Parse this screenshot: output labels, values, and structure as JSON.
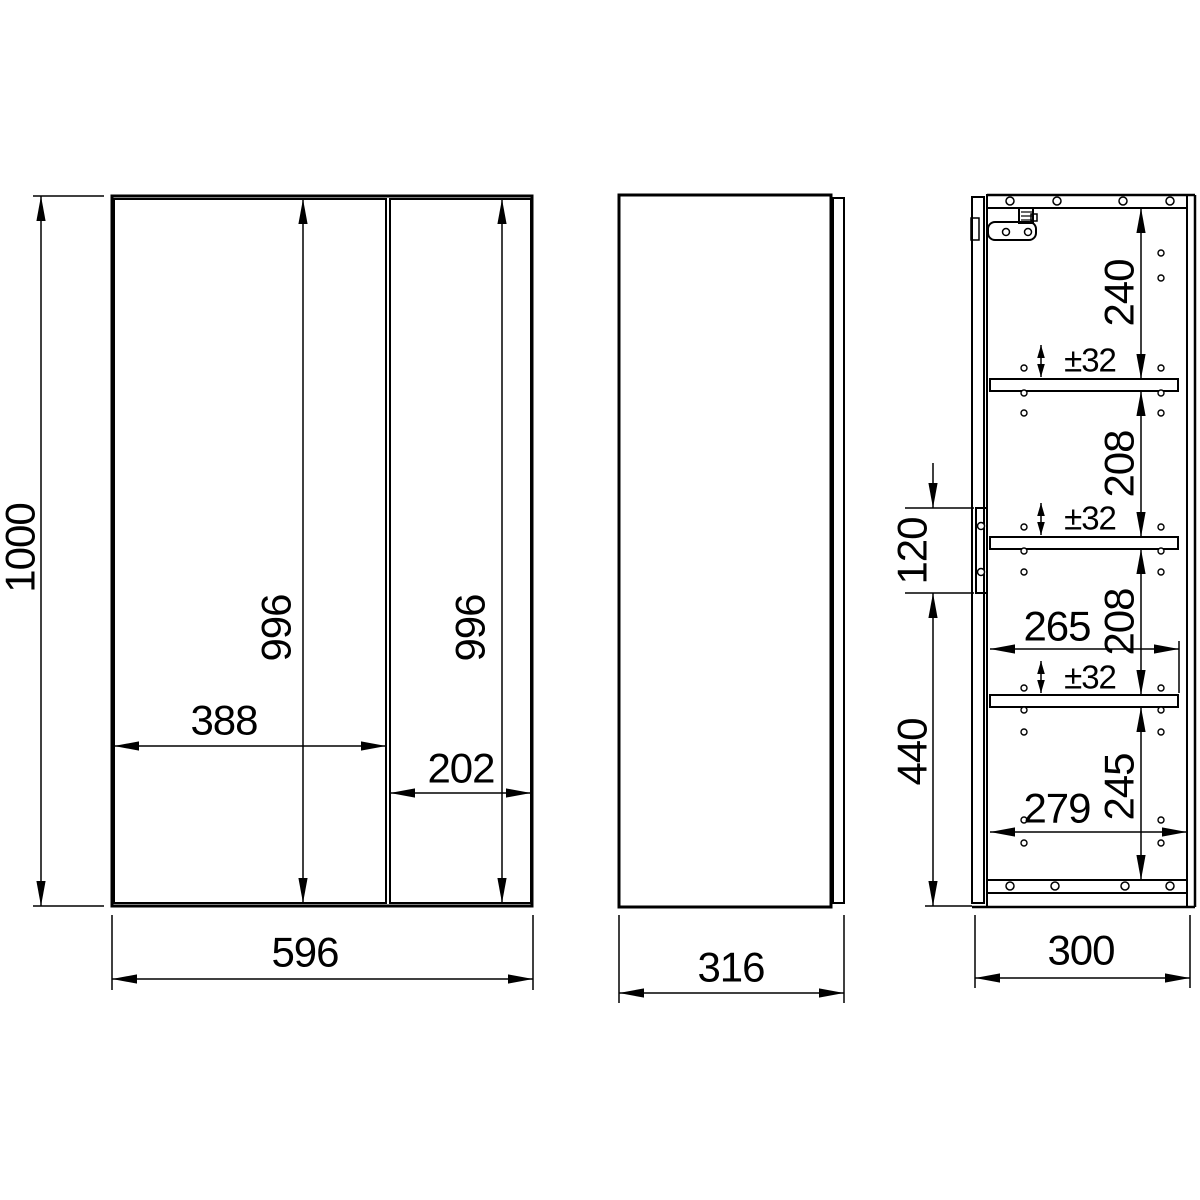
{
  "canvas": {
    "width": 1200,
    "height": 1200,
    "background": "#ffffff",
    "line_color": "#000000"
  },
  "styles": {
    "thick": 3,
    "med": 2,
    "thin": 1.5,
    "font_main": 42,
    "font_small": 33
  },
  "views": {
    "front-view": {
      "rects": [
        {
          "name": "cabinet-outline",
          "x": 112,
          "y": 196,
          "w": 420,
          "h": 710,
          "sw": 3
        },
        {
          "name": "left-door-panel",
          "x": 114,
          "y": 199,
          "w": 272,
          "h": 704,
          "sw": 2
        },
        {
          "name": "right-door-panel",
          "x": 390,
          "y": 199,
          "w": 141,
          "h": 704,
          "sw": 2
        }
      ],
      "lines": [],
      "circles": []
    },
    "side-view": {
      "rects": [
        {
          "name": "side-body-outline",
          "x": 619,
          "y": 195,
          "w": 212,
          "h": 712,
          "sw": 3
        },
        {
          "name": "side-door-edge",
          "x": 833,
          "y": 198,
          "w": 11,
          "h": 705,
          "sw": 2
        }
      ],
      "lines": [],
      "circles": []
    },
    "section-view": {
      "rects": [
        {
          "name": "section-door-panel",
          "x": 972,
          "y": 197,
          "w": 12,
          "h": 706,
          "sw": 2
        },
        {
          "name": "top-panel",
          "x": 987,
          "y": 195,
          "w": 200,
          "h": 13,
          "sw": 2
        },
        {
          "name": "bottom-panel",
          "x": 987,
          "y": 880,
          "w": 200,
          "h": 13,
          "sw": 2
        },
        {
          "name": "shelf-1",
          "x": 990,
          "y": 379,
          "w": 188,
          "h": 12,
          "sw": 2
        },
        {
          "name": "shelf-2",
          "x": 990,
          "y": 537,
          "w": 188,
          "h": 12,
          "sw": 2
        },
        {
          "name": "shelf-3",
          "x": 990,
          "y": 695,
          "w": 188,
          "h": 12,
          "sw": 2
        },
        {
          "name": "top-hinge-mechanism",
          "x": 1019,
          "y": 208,
          "w": 14,
          "h": 15,
          "sw": 2
        },
        {
          "name": "top-hinge-step",
          "x": 1031,
          "y": 214,
          "w": 6,
          "h": 7,
          "sw": 1.5
        },
        {
          "name": "top-hinge-plate",
          "x": 988,
          "y": 222,
          "w": 48,
          "h": 18,
          "sw": 2,
          "rx": 7
        },
        {
          "name": "door-hinge-cup",
          "x": 971,
          "y": 218,
          "w": 8,
          "h": 22,
          "sw": 1.5
        },
        {
          "name": "middle-hinge-plate",
          "x": 976,
          "y": 508,
          "w": 11,
          "h": 85,
          "sw": 2
        }
      ],
      "lines": [
        {
          "name": "carcass-front-edge",
          "p": [
            987,
            195,
            987,
            907
          ],
          "sw": 2
        },
        {
          "name": "back-panel-inner",
          "p": [
            1187,
            195,
            1187,
            907
          ],
          "sw": 2
        },
        {
          "name": "back-panel-outer",
          "p": [
            1195,
            195,
            1195,
            907
          ],
          "sw": 2.5
        },
        {
          "name": "top-edge",
          "p": [
            987,
            195,
            1195,
            195
          ],
          "sw": 2.5
        },
        {
          "name": "bottom-edge",
          "p": [
            972,
            907,
            1195,
            907
          ],
          "sw": 2.5
        },
        {
          "name": "top-hinge-arm",
          "p": [
            987,
            208,
            1020,
            208
          ],
          "sw": 2
        },
        {
          "name": "hinge-hatch-1",
          "p": [
            1021,
            212,
            1032,
            212
          ],
          "sw": 1.2
        },
        {
          "name": "hinge-hatch-2",
          "p": [
            1021,
            216,
            1032,
            216
          ],
          "sw": 1.2
        },
        {
          "name": "hinge-hatch-3",
          "p": [
            1021,
            220,
            1032,
            220
          ],
          "sw": 1.2
        }
      ],
      "circles": [
        {
          "name": "top-panel-screw-hole",
          "cx": 1010,
          "cy": 201,
          "r": 4,
          "sw": 1.5
        },
        {
          "name": "top-panel-screw-hole",
          "cx": 1057,
          "cy": 201,
          "r": 4,
          "sw": 1.5
        },
        {
          "name": "top-panel-screw-hole",
          "cx": 1123,
          "cy": 201,
          "r": 4,
          "sw": 1.5
        },
        {
          "name": "top-panel-screw-hole",
          "cx": 1170,
          "cy": 201,
          "r": 4,
          "sw": 1.5
        },
        {
          "name": "bottom-panel-screw-hole",
          "cx": 1010,
          "cy": 886,
          "r": 4,
          "sw": 1.5
        },
        {
          "name": "bottom-panel-screw-hole",
          "cx": 1055,
          "cy": 886,
          "r": 4,
          "sw": 1.5
        },
        {
          "name": "bottom-panel-screw-hole",
          "cx": 1125,
          "cy": 886,
          "r": 4,
          "sw": 1.5
        },
        {
          "name": "bottom-panel-screw-hole",
          "cx": 1170,
          "cy": 886,
          "r": 4,
          "sw": 1.5
        },
        {
          "name": "hinge-screw",
          "cx": 1006,
          "cy": 232,
          "r": 3.5,
          "sw": 1.5
        },
        {
          "name": "hinge-screw",
          "cx": 1028,
          "cy": 232,
          "r": 3.5,
          "sw": 1.5
        },
        {
          "name": "middle-hinge-screw",
          "cx": 981,
          "cy": 526,
          "r": 3.5,
          "sw": 1.5
        },
        {
          "name": "middle-hinge-screw",
          "cx": 981,
          "cy": 572,
          "r": 3.5,
          "sw": 1.5
        },
        {
          "name": "shelf-pin-hole",
          "cx": 1024,
          "cy": 368,
          "r": 3,
          "sw": 1.4
        },
        {
          "name": "shelf-pin-hole",
          "cx": 1024,
          "cy": 393,
          "r": 3,
          "sw": 1.4
        },
        {
          "name": "shelf-pin-hole",
          "cx": 1024,
          "cy": 413,
          "r": 3,
          "sw": 1.4
        },
        {
          "name": "shelf-pin-hole",
          "cx": 1024,
          "cy": 527,
          "r": 3,
          "sw": 1.4
        },
        {
          "name": "shelf-pin-hole",
          "cx": 1024,
          "cy": 551,
          "r": 3,
          "sw": 1.4
        },
        {
          "name": "shelf-pin-hole",
          "cx": 1024,
          "cy": 572,
          "r": 3,
          "sw": 1.4
        },
        {
          "name": "shelf-pin-hole",
          "cx": 1024,
          "cy": 688,
          "r": 3,
          "sw": 1.4
        },
        {
          "name": "shelf-pin-hole",
          "cx": 1024,
          "cy": 710,
          "r": 3,
          "sw": 1.4
        },
        {
          "name": "shelf-pin-hole",
          "cx": 1024,
          "cy": 732,
          "r": 3,
          "sw": 1.4
        },
        {
          "name": "shelf-pin-hole",
          "cx": 1024,
          "cy": 820,
          "r": 3,
          "sw": 1.4
        },
        {
          "name": "shelf-pin-hole",
          "cx": 1024,
          "cy": 843,
          "r": 3,
          "sw": 1.4
        },
        {
          "name": "shelf-pin-hole",
          "cx": 1161,
          "cy": 253,
          "r": 3,
          "sw": 1.4
        },
        {
          "name": "shelf-pin-hole",
          "cx": 1161,
          "cy": 278,
          "r": 3,
          "sw": 1.4
        },
        {
          "name": "shelf-pin-hole",
          "cx": 1161,
          "cy": 368,
          "r": 3,
          "sw": 1.4
        },
        {
          "name": "shelf-pin-hole",
          "cx": 1161,
          "cy": 393,
          "r": 3,
          "sw": 1.4
        },
        {
          "name": "shelf-pin-hole",
          "cx": 1161,
          "cy": 413,
          "r": 3,
          "sw": 1.4
        },
        {
          "name": "shelf-pin-hole",
          "cx": 1161,
          "cy": 527,
          "r": 3,
          "sw": 1.4
        },
        {
          "name": "shelf-pin-hole",
          "cx": 1161,
          "cy": 551,
          "r": 3,
          "sw": 1.4
        },
        {
          "name": "shelf-pin-hole",
          "cx": 1161,
          "cy": 572,
          "r": 3,
          "sw": 1.4
        },
        {
          "name": "shelf-pin-hole",
          "cx": 1161,
          "cy": 688,
          "r": 3,
          "sw": 1.4
        },
        {
          "name": "shelf-pin-hole",
          "cx": 1161,
          "cy": 710,
          "r": 3,
          "sw": 1.4
        },
        {
          "name": "shelf-pin-hole",
          "cx": 1161,
          "cy": 732,
          "r": 3,
          "sw": 1.4
        },
        {
          "name": "shelf-pin-hole",
          "cx": 1161,
          "cy": 820,
          "r": 3,
          "sw": 1.4
        },
        {
          "name": "shelf-pin-hole",
          "cx": 1161,
          "cy": 843,
          "r": 3,
          "sw": 1.4
        }
      ]
    }
  },
  "dimensions": [
    {
      "id": "overall-height",
      "label": "1000",
      "lines": [
        [
          41,
          196,
          41,
          906
        ]
      ],
      "arrows": [
        [
          41,
          196,
          "up"
        ],
        [
          41,
          906,
          "down"
        ]
      ],
      "exts": [
        [
          33,
          196,
          104,
          196
        ],
        [
          33,
          906,
          104,
          906
        ]
      ],
      "label_pos": [
        20,
        548
      ],
      "rotated": true,
      "font": "main"
    },
    {
      "id": "left-door-height",
      "label": "996",
      "lines": [
        [
          303,
          199,
          303,
          903
        ]
      ],
      "arrows": [
        [
          303,
          199,
          "up"
        ],
        [
          303,
          903,
          "down"
        ]
      ],
      "exts": [],
      "label_pos": [
        276,
        628
      ],
      "rotated": true,
      "font": "main"
    },
    {
      "id": "right-door-height",
      "label": "996",
      "lines": [
        [
          502,
          199,
          502,
          903
        ]
      ],
      "arrows": [
        [
          502,
          199,
          "up"
        ],
        [
          502,
          903,
          "down"
        ]
      ],
      "exts": [],
      "label_pos": [
        470,
        628
      ],
      "rotated": true,
      "font": "main"
    },
    {
      "id": "left-door-width",
      "label": "388",
      "lines": [
        [
          114,
          746,
          386,
          746
        ]
      ],
      "arrows": [
        [
          114,
          746,
          "left"
        ],
        [
          386,
          746,
          "right"
        ]
      ],
      "exts": [],
      "label_pos": [
        224,
        720
      ],
      "rotated": false,
      "font": "main"
    },
    {
      "id": "right-door-width",
      "label": "202",
      "lines": [
        [
          390,
          793,
          531,
          793
        ]
      ],
      "arrows": [
        [
          390,
          793,
          "left"
        ],
        [
          531,
          793,
          "right"
        ]
      ],
      "exts": [],
      "label_pos": [
        461,
        768
      ],
      "rotated": false,
      "font": "main"
    },
    {
      "id": "overall-width",
      "label": "596",
      "lines": [
        [
          112,
          979,
          533,
          979
        ]
      ],
      "arrows": [
        [
          112,
          979,
          "left"
        ],
        [
          533,
          979,
          "right"
        ]
      ],
      "exts": [
        [
          112,
          915,
          112,
          990
        ],
        [
          533,
          915,
          533,
          990
        ]
      ],
      "label_pos": [
        305,
        952
      ],
      "rotated": false,
      "font": "main"
    },
    {
      "id": "overall-depth",
      "label": "316",
      "lines": [
        [
          619,
          993,
          844,
          993
        ]
      ],
      "arrows": [
        [
          619,
          993,
          "left"
        ],
        [
          844,
          993,
          "right"
        ]
      ],
      "exts": [
        [
          619,
          915,
          619,
          1003
        ],
        [
          844,
          915,
          844,
          1003
        ]
      ],
      "label_pos": [
        731,
        967
      ],
      "rotated": false,
      "font": "main"
    },
    {
      "id": "top-shelf-space",
      "label": "240",
      "lines": [
        [
          1141,
          208,
          1141,
          379
        ]
      ],
      "arrows": [
        [
          1141,
          208,
          "up"
        ],
        [
          1141,
          379,
          "down"
        ]
      ],
      "exts": [],
      "label_pos": [
        1119,
        293
      ],
      "rotated": true,
      "font": "main"
    },
    {
      "id": "shelf-space-1",
      "label": "208",
      "lines": [
        [
          1141,
          391,
          1141,
          537
        ]
      ],
      "arrows": [
        [
          1141,
          391,
          "up"
        ],
        [
          1141,
          537,
          "down"
        ]
      ],
      "exts": [],
      "label_pos": [
        1119,
        464
      ],
      "rotated": true,
      "font": "main"
    },
    {
      "id": "shelf-space-2",
      "label": "208",
      "lines": [
        [
          1141,
          549,
          1141,
          695
        ]
      ],
      "arrows": [
        [
          1141,
          549,
          "up"
        ],
        [
          1141,
          695,
          "down"
        ]
      ],
      "exts": [],
      "label_pos": [
        1119,
        622
      ],
      "rotated": true,
      "font": "main"
    },
    {
      "id": "bottom-shelf-space",
      "label": "245",
      "lines": [
        [
          1141,
          707,
          1141,
          880
        ]
      ],
      "arrows": [
        [
          1141,
          707,
          "up"
        ],
        [
          1141,
          880,
          "down"
        ]
      ],
      "exts": [],
      "label_pos": [
        1119,
        787
      ],
      "rotated": true,
      "font": "main"
    },
    {
      "id": "shelf-depth",
      "label": "265",
      "lines": [
        [
          990,
          649,
          1179,
          649
        ]
      ],
      "arrows": [
        [
          990,
          649,
          "left"
        ],
        [
          1179,
          649,
          "right"
        ]
      ],
      "exts": [
        [
          1179,
          641,
          1179,
          693
        ]
      ],
      "label_pos": [
        1057,
        626
      ],
      "rotated": false,
      "font": "main"
    },
    {
      "id": "interior-depth",
      "label": "279",
      "lines": [
        [
          990,
          832,
          1187,
          832
        ]
      ],
      "arrows": [
        [
          990,
          832,
          "left"
        ],
        [
          1187,
          832,
          "right"
        ]
      ],
      "exts": [],
      "label_pos": [
        1057,
        808
      ],
      "rotated": false,
      "font": "main"
    },
    {
      "id": "carcass-depth",
      "label": "300",
      "lines": [
        [
          975,
          978,
          1190,
          978
        ]
      ],
      "arrows": [
        [
          975,
          978,
          "left"
        ],
        [
          1190,
          978,
          "right"
        ]
      ],
      "exts": [
        [
          975,
          915,
          975,
          988
        ],
        [
          1190,
          915,
          1190,
          988
        ]
      ],
      "label_pos": [
        1081,
        950
      ],
      "rotated": false,
      "font": "main"
    },
    {
      "id": "hinge-plate-position",
      "label": "120",
      "lines": [
        [
          933,
          463,
          933,
          508
        ]
      ],
      "arrows": [
        [
          933,
          508,
          "down"
        ]
      ],
      "exts": [
        [
          905,
          508,
          974,
          508
        ],
        [
          905,
          593,
          974,
          593
        ]
      ],
      "label_pos": [
        912,
        551
      ],
      "rotated": true,
      "font": "main"
    },
    {
      "id": "hinge-to-bottom",
      "label": "440",
      "lines": [
        [
          933,
          593,
          933,
          906
        ]
      ],
      "arrows": [
        [
          933,
          593,
          "up"
        ],
        [
          933,
          906,
          "down"
        ]
      ],
      "exts": [
        [
          925,
          906,
          972,
          906
        ]
      ],
      "label_pos": [
        912,
        752
      ],
      "rotated": true,
      "font": "main"
    },
    {
      "id": "shelf-1-adjustability",
      "label": "±32",
      "lines": [
        [
          1041,
          345,
          1041,
          377
        ]
      ],
      "arrows": [
        [
          1041,
          345,
          "up"
        ],
        [
          1041,
          377,
          "down"
        ]
      ],
      "exts": [],
      "label_pos": [
        1090,
        360
      ],
      "rotated": false,
      "font": "small",
      "small_arrows": true
    },
    {
      "id": "shelf-2-adjustability",
      "label": "±32",
      "lines": [
        [
          1041,
          503,
          1041,
          535
        ]
      ],
      "arrows": [
        [
          1041,
          503,
          "up"
        ],
        [
          1041,
          535,
          "down"
        ]
      ],
      "exts": [],
      "label_pos": [
        1090,
        518
      ],
      "rotated": false,
      "font": "small",
      "small_arrows": true
    },
    {
      "id": "shelf-3-adjustability",
      "label": "±32",
      "lines": [
        [
          1041,
          661,
          1041,
          693
        ]
      ],
      "arrows": [
        [
          1041,
          661,
          "up"
        ],
        [
          1041,
          693,
          "down"
        ]
      ],
      "exts": [],
      "label_pos": [
        1090,
        677
      ],
      "rotated": false,
      "font": "small",
      "small_arrows": true
    }
  ]
}
